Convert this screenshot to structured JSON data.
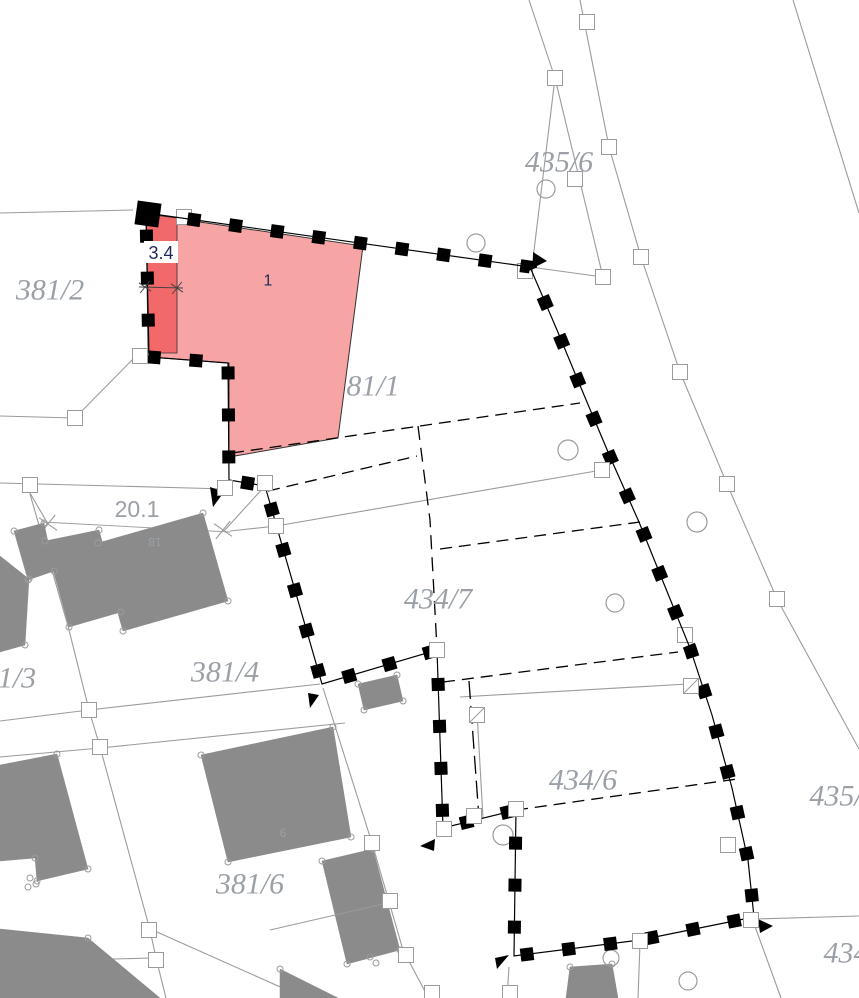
{
  "canvas": {
    "w": 859,
    "h": 998,
    "bg": "#ffffff"
  },
  "palette": {
    "highlight_fill": "#f6a4a4",
    "highlight_strip": "#f26969",
    "building_fill": "#8b8b8b",
    "line_gray": "#9b9b9b",
    "label_gray": "#9aa0a6",
    "boundary_black": "#000000",
    "dim_dark": "#444444",
    "measure_navy": "#1e2b5a",
    "white": "#ffffff"
  },
  "parcel_labels": [
    {
      "id": "381-2",
      "text": "381/2",
      "x": 50,
      "y": 290,
      "size": 30
    },
    {
      "id": "435-6",
      "text": "435/6",
      "x": 559,
      "y": 162,
      "size": 30
    },
    {
      "id": "381-1",
      "text": "81/1",
      "x": 373,
      "y": 386,
      "size": 30
    },
    {
      "id": "434-7",
      "text": "434/7",
      "x": 438,
      "y": 599,
      "size": 30
    },
    {
      "id": "381-4",
      "text": "381/4",
      "x": 225,
      "y": 672,
      "size": 30
    },
    {
      "id": "381-3",
      "text": "1/3",
      "x": 17,
      "y": 678,
      "size": 30
    },
    {
      "id": "381-6",
      "text": "381/6",
      "x": 250,
      "y": 884,
      "size": 30
    },
    {
      "id": "434-6",
      "text": "434/6",
      "x": 583,
      "y": 780,
      "size": 30
    },
    {
      "id": "435",
      "text": "435/",
      "x": 836,
      "y": 796,
      "size": 30
    },
    {
      "id": "434",
      "text": "434",
      "x": 846,
      "y": 953,
      "size": 30
    }
  ],
  "building_labels": [
    {
      "text": "18",
      "x": 155,
      "y": 542,
      "size": 12,
      "rotate": 180
    },
    {
      "text": "6",
      "x": 283,
      "y": 833,
      "size": 12,
      "rotate": 0
    }
  ],
  "highlight": {
    "label": {
      "text": "1",
      "x": 268,
      "y": 281,
      "size": 16
    },
    "outer": [
      [
        146,
        214
      ],
      [
        363,
        246
      ],
      [
        352,
        331
      ],
      [
        338,
        438
      ],
      [
        229,
        457
      ],
      [
        229,
        363
      ],
      [
        150,
        357
      ]
    ],
    "strip": [
      [
        146,
        214
      ],
      [
        177,
        218
      ],
      [
        177,
        353
      ],
      [
        148,
        353
      ]
    ]
  },
  "measurements": {
    "width": {
      "text": "3.4",
      "x": 161,
      "y": 253,
      "size": 18,
      "box": [
        144,
        241,
        34,
        22
      ],
      "line": [
        [
          139,
          287
        ],
        [
          183,
          288
        ]
      ],
      "ticks": [
        [
          145,
          287
        ],
        [
          177,
          288
        ]
      ]
    },
    "length": {
      "text": "20.1",
      "x": 137,
      "y": 509,
      "size": 23,
      "line": [
        [
          42,
          522
        ],
        [
          230,
          532
        ]
      ],
      "ticks": [
        [
          48,
          524
        ],
        [
          223,
          530
        ]
      ]
    }
  },
  "boundary": {
    "closed": true,
    "pts": [
      [
        146,
        213
      ],
      [
        530,
        267
      ],
      [
        557,
        330
      ],
      [
        584,
        395
      ],
      [
        611,
        459
      ],
      [
        639,
        522
      ],
      [
        664,
        584
      ],
      [
        690,
        648
      ],
      [
        712,
        715
      ],
      [
        732,
        788
      ],
      [
        748,
        860
      ],
      [
        754,
        917
      ],
      [
        640,
        940
      ],
      [
        514,
        956
      ],
      [
        516,
        810
      ],
      [
        443,
        828
      ],
      [
        437,
        650
      ],
      [
        322,
        684
      ],
      [
        265,
        486
      ],
      [
        229,
        480
      ],
      [
        228,
        363
      ],
      [
        149,
        357
      ]
    ],
    "corner_rect": {
      "cx": 148,
      "cy": 214,
      "size": 24,
      "rot": 8
    },
    "square_dash": "13 29",
    "square_width": 13
  },
  "flags": [
    [
      [
        533,
        252
      ],
      [
        547,
        261
      ],
      [
        533,
        268
      ]
    ],
    [
      [
        210,
        487
      ],
      [
        224,
        492
      ],
      [
        213,
        507
      ]
    ],
    [
      [
        308,
        693
      ],
      [
        319,
        695
      ],
      [
        310,
        708
      ]
    ],
    [
      [
        435,
        839
      ],
      [
        420,
        846
      ],
      [
        434,
        851
      ]
    ],
    [
      [
        509,
        955
      ],
      [
        495,
        958
      ],
      [
        497,
        969
      ]
    ],
    [
      [
        758,
        919
      ],
      [
        773,
        926
      ],
      [
        760,
        933
      ]
    ]
  ],
  "gray_lines": [
    [
      [
        0,
        213
      ],
      [
        133,
        210
      ]
    ],
    [
      [
        135,
        357
      ],
      [
        75,
        418
      ],
      [
        0,
        416
      ]
    ],
    [
      [
        0,
        483
      ],
      [
        227,
        489
      ]
    ],
    [
      [
        23,
        481
      ],
      [
        48,
        524
      ]
    ],
    [
      [
        224,
        531
      ],
      [
        264,
        487
      ]
    ],
    [
      [
        230,
        531
      ],
      [
        276,
        526
      ],
      [
        602,
        470
      ]
    ],
    [
      [
        30,
        494
      ],
      [
        68,
        626
      ],
      [
        89,
        710
      ],
      [
        100,
        747
      ],
      [
        150,
        930
      ],
      [
        156,
        958
      ],
      [
        166,
        998
      ]
    ],
    [
      [
        0,
        721
      ],
      [
        89,
        710
      ],
      [
        320,
        684
      ]
    ],
    [
      [
        0,
        757
      ],
      [
        100,
        748
      ],
      [
        345,
        723
      ]
    ],
    [
      [
        0,
        962
      ],
      [
        152,
        958
      ]
    ],
    [
      [
        148,
        928
      ],
      [
        305,
        998
      ]
    ],
    [
      [
        323,
        688
      ],
      [
        372,
        843
      ],
      [
        403,
        950
      ],
      [
        428,
        997
      ]
    ],
    [
      [
        509,
        967
      ],
      [
        507,
        998
      ]
    ],
    [
      [
        529,
        0
      ],
      [
        555,
        78
      ],
      [
        532,
        267
      ]
    ],
    [
      [
        555,
        78
      ],
      [
        603,
        277
      ]
    ],
    [
      [
        530,
        267
      ],
      [
        603,
        277
      ]
    ],
    [
      [
        580,
        0
      ],
      [
        609,
        147
      ],
      [
        641,
        257
      ],
      [
        680,
        372
      ],
      [
        727,
        484
      ],
      [
        777,
        599
      ],
      [
        859,
        749
      ]
    ],
    [
      [
        793,
        0
      ],
      [
        859,
        213
      ]
    ],
    [
      [
        754,
        919
      ],
      [
        859,
        916
      ]
    ],
    [
      [
        753,
        921
      ],
      [
        781,
        998
      ]
    ],
    [
      [
        460,
        697
      ],
      [
        688,
        684
      ]
    ],
    [
      [
        477,
        712
      ],
      [
        483,
        818
      ]
    ],
    [
      [
        640,
        943
      ],
      [
        638,
        998
      ]
    ]
  ],
  "dashed_lines": [
    {
      "pts": [
        [
          232,
          453
        ],
        [
          580,
          403
        ]
      ],
      "dash": "12 7"
    },
    {
      "pts": [
        [
          268,
          491
        ],
        [
          417,
          456
        ]
      ],
      "dash": "12 7"
    },
    {
      "pts": [
        [
          418,
          426
        ],
        [
          430,
          520
        ],
        [
          437,
          649
        ]
      ],
      "dash": "14 8"
    },
    {
      "pts": [
        [
          440,
          549
        ],
        [
          640,
          522
        ]
      ],
      "dash": "12 7"
    },
    {
      "pts": [
        [
          516,
          810
        ],
        [
          737,
          779
        ]
      ],
      "dash": "12 7"
    },
    {
      "pts": [
        [
          443,
          682
        ],
        [
          678,
          652
        ]
      ],
      "dash": "12 7"
    },
    {
      "pts": [
        [
          469,
          681
        ],
        [
          479,
          818
        ]
      ],
      "dash": "18 7"
    }
  ],
  "buildings": [
    [
      [
        14,
        531
      ],
      [
        44,
        523
      ],
      [
        54,
        571
      ],
      [
        28,
        580
      ]
    ],
    [
      [
        45,
        541
      ],
      [
        99,
        530
      ],
      [
        121,
        612
      ],
      [
        69,
        627
      ]
    ],
    [
      [
        98,
        543
      ],
      [
        203,
        513
      ],
      [
        228,
        601
      ],
      [
        123,
        631
      ]
    ],
    [
      [
        0,
        556
      ],
      [
        29,
        579
      ],
      [
        25,
        645
      ],
      [
        0,
        652
      ]
    ],
    [
      [
        0,
        765
      ],
      [
        57,
        754
      ],
      [
        88,
        869
      ],
      [
        37,
        881
      ],
      [
        35,
        858
      ],
      [
        0,
        861
      ]
    ],
    [
      [
        201,
        755
      ],
      [
        333,
        727
      ],
      [
        351,
        837
      ],
      [
        228,
        862
      ]
    ],
    [
      [
        358,
        684
      ],
      [
        397,
        675
      ],
      [
        403,
        701
      ],
      [
        364,
        710
      ]
    ],
    [
      [
        322,
        861
      ],
      [
        373,
        849
      ],
      [
        400,
        950
      ],
      [
        347,
        964
      ]
    ],
    [
      [
        280,
        969
      ],
      [
        338,
        998
      ],
      [
        280,
        998
      ]
    ],
    [
      [
        570,
        967
      ],
      [
        612,
        964
      ],
      [
        618,
        998
      ],
      [
        566,
        998
      ]
    ],
    [
      [
        0,
        929
      ],
      [
        88,
        938
      ],
      [
        160,
        998
      ],
      [
        0,
        998
      ]
    ]
  ],
  "building_internal_lines": [
    [
      [
        270,
        930
      ],
      [
        392,
        902
      ]
    ]
  ],
  "big_circles": [
    [
      546,
      189,
      9
    ],
    [
      476,
      243,
      9
    ],
    [
      568,
      450,
      10
    ],
    [
      697,
      522,
      10
    ],
    [
      615,
      603,
      9
    ],
    [
      503,
      835,
      10
    ],
    [
      611,
      958,
      8
    ],
    [
      688,
      981,
      9
    ]
  ],
  "extra_small_circles": [
    [
      30,
      878
    ],
    [
      36,
      884
    ],
    [
      28,
      887
    ],
    [
      370,
      957
    ],
    [
      376,
      963
    ]
  ],
  "point_squares_back": [
    [
      184,
      217
    ],
    [
      525,
      271
    ],
    [
      685,
      635
    ]
  ],
  "point_squares": [
    [
      587,
      22
    ],
    [
      555,
      78
    ],
    [
      609,
      147
    ],
    [
      575,
      179
    ],
    [
      641,
      257
    ],
    [
      603,
      277
    ],
    [
      140,
      356
    ],
    [
      75,
      418
    ],
    [
      30,
      485
    ],
    [
      225,
      488
    ],
    [
      265,
      483
    ],
    [
      276,
      526
    ],
    [
      602,
      470
    ],
    [
      680,
      372
    ],
    [
      727,
      484
    ],
    [
      777,
      599
    ],
    [
      437,
      650
    ],
    [
      89,
      710
    ],
    [
      100,
      747
    ],
    [
      444,
      829
    ],
    [
      474,
      816
    ],
    [
      516,
      809
    ],
    [
      728,
      845
    ],
    [
      751,
      920
    ],
    [
      640,
      941
    ],
    [
      149,
      930
    ],
    [
      156,
      960
    ],
    [
      372,
      843
    ],
    [
      390,
      901
    ],
    [
      406,
      955
    ],
    [
      432,
      993
    ],
    [
      510,
      993
    ]
  ],
  "slashed_squares": [
    [
      477,
      715
    ],
    [
      691,
      686
    ]
  ],
  "point_square_size": 15
}
